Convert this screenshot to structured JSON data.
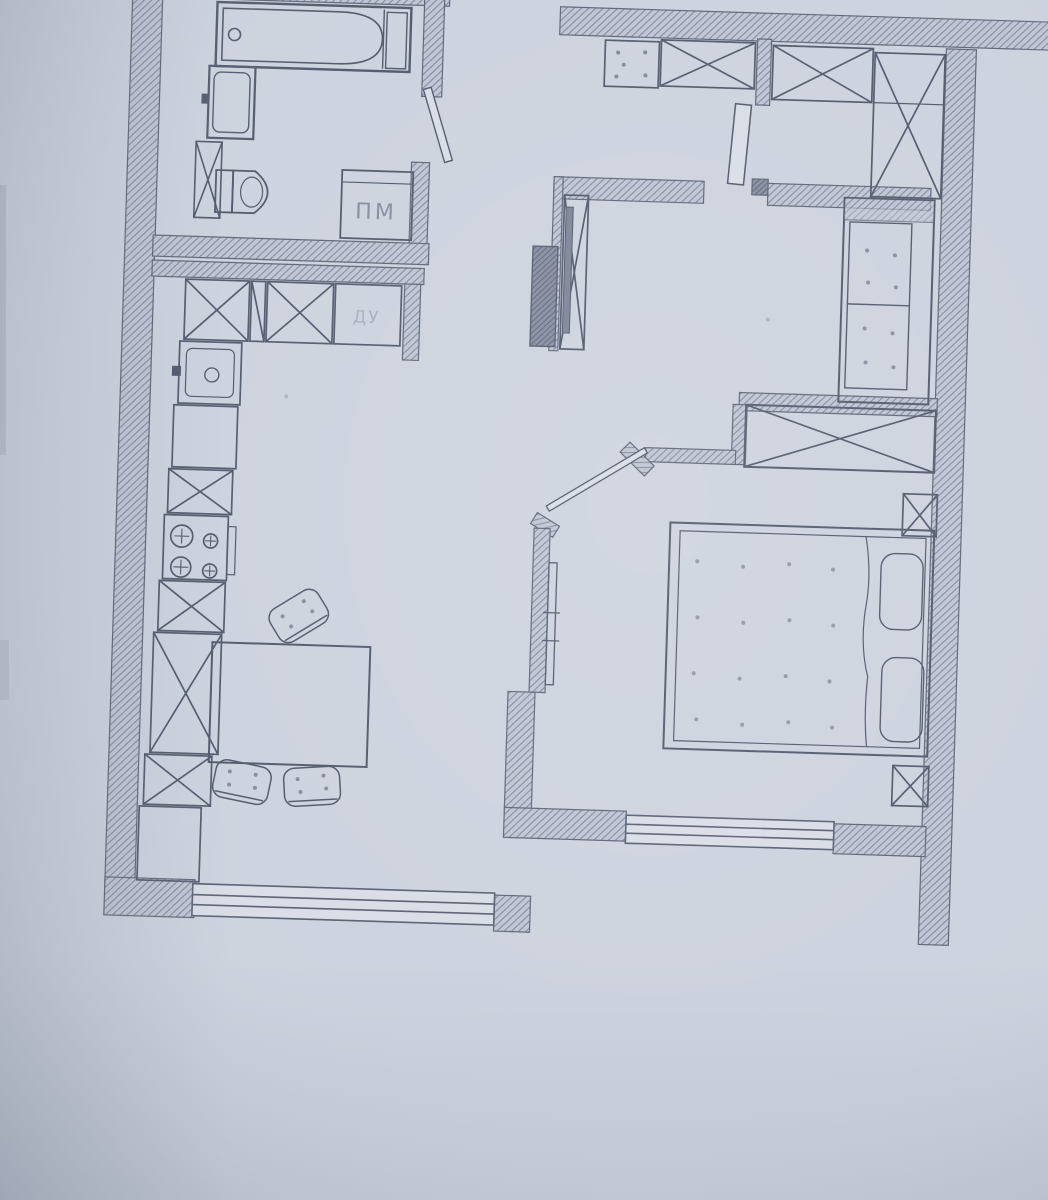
{
  "document": {
    "kind": "scanned-floor-plan",
    "technique": "pencil-on-paper",
    "rooms": [
      "bathroom",
      "hallway",
      "kitchen-dining",
      "corridor",
      "living-room",
      "bedroom"
    ]
  },
  "palette": {
    "paper": "#cdd3de",
    "paper-light": "#d9dde6",
    "paper-shadow": "#aab1c0",
    "line": "#525a6d",
    "line-soft": "#7b8296",
    "wall-fill": "#bfc5d3",
    "wall-line": "#858ca0",
    "block-fill": "#868da0",
    "block-line": "#5c6377"
  },
  "annotations": {
    "washer_label": "ПМ",
    "counter_label": "ДУ"
  },
  "fixtures": {
    "bathroom": [
      "bathtub",
      "washbasin",
      "toilet",
      "washing-machine",
      "vent-duct",
      "door"
    ],
    "hallway": [
      "shoe-cabinet",
      "wardrobe",
      "wardrobe",
      "corner-wardrobe",
      "entry-door-leaf"
    ],
    "kitchen": [
      "cabinets-x",
      "sink",
      "stove-4-burners",
      "refrigerator",
      "dining-table",
      "chair",
      "chair",
      "chair",
      "window"
    ],
    "living_room": [
      "tv",
      "tv-stand",
      "shelf-block",
      "sofa"
    ],
    "bedroom": [
      "wardrobe",
      "double-bed",
      "pillow",
      "pillow",
      "nightstand",
      "nightstand",
      "radiator",
      "door-leaf",
      "window"
    ]
  }
}
